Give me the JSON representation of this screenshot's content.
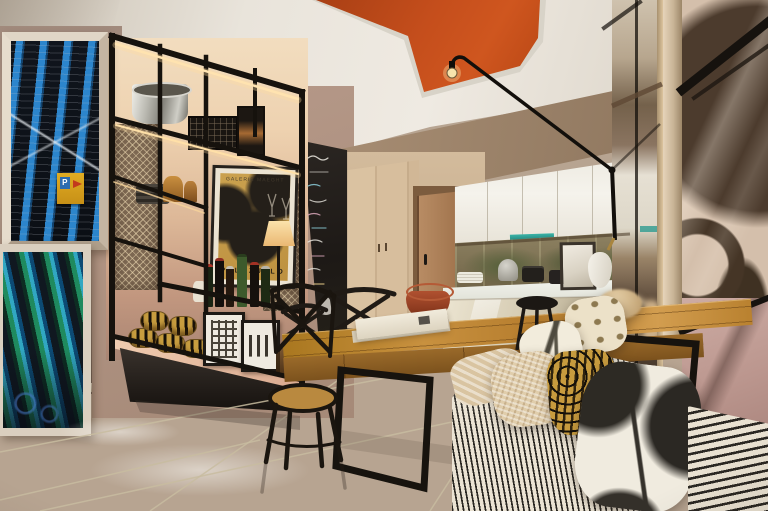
{
  "scene": {
    "type": "interior-photograph",
    "setting": "Modern open-plan apartment dining room with industrial black metal shelving, wooden dining table, striped bench sofa, kitchen and mirrored wall",
    "texts": {
      "poster_gallery": "GALERIE MAEGHT",
      "poster_artist": "PALAZUELO",
      "parking_letter": "P"
    },
    "palette": {
      "ceiling": "#e8e3da",
      "accent_orange": "#c2501d",
      "wall_taupe": "#ac9284",
      "backlight_warm": "#eed3b3",
      "metal_black": "#17130e",
      "wood_table": "#bb8538",
      "wardrobe_wood": "#d5bc9b",
      "door_wood": "#a87c55",
      "floor_cream": "#ebe2cc",
      "sofa_stripe_dark": "#2a2722",
      "sofa_stripe_light": "#ece4d4",
      "leopard_gold": "#c79b3e",
      "poster_gold": "#c49947",
      "teal_accent": "#2fa39a",
      "mirror_bronze": "#8a7460",
      "artwork_pink": "#c2a39c"
    },
    "objects": [
      {
        "name": "recessed-orange-ceiling-panel",
        "label": "Orange recessed ceiling panel with hanging bulb"
      },
      {
        "name": "potence-swing-arm-lamp",
        "label": "Black swing-arm wall lamp"
      },
      {
        "name": "pompidou-artwork-upper",
        "label": "Framed photo of blue building pipes with parking sign"
      },
      {
        "name": "pompidou-artwork-lower",
        "label": "Framed photo of green and blue diagonal tubes"
      },
      {
        "name": "black-metal-shelving",
        "label": "Backlit black metal shelving unit with mesh panels"
      },
      {
        "name": "gallery-poster",
        "label": "Gold Palazuelo gallery poster"
      },
      {
        "name": "chalkboard",
        "label": "Chalkboard strip with handwritten menu"
      },
      {
        "name": "wardrobe",
        "label": "Light wood wardrobe"
      },
      {
        "name": "entry-door",
        "label": "Wooden entry door"
      },
      {
        "name": "kitchen",
        "label": "White kitchen cabinets with bronze backsplash"
      },
      {
        "name": "island-counter",
        "label": "White kitchen island counter"
      },
      {
        "name": "bar-stool",
        "label": "Black bar stool"
      },
      {
        "name": "dining-table",
        "label": "Plank wood dining table with black steel legs"
      },
      {
        "name": "terracotta-bowl",
        "label": "Terracotta bowl"
      },
      {
        "name": "magazines",
        "label": "Stack of magazines"
      },
      {
        "name": "bistro-chairs",
        "label": "Black cross-back bistro chairs"
      },
      {
        "name": "striped-bench-sofa",
        "label": "Black and white ticking stripe bench sofa"
      },
      {
        "name": "patterned-pillows",
        "label": "Assorted animal print and woven pillows"
      },
      {
        "name": "mirror-wall",
        "label": "Mirrored wall panel"
      },
      {
        "name": "abstract-artwork-right",
        "label": "Large abstract circle artwork behind glass"
      },
      {
        "name": "tile-floor",
        "label": "Glossy cream tile floor"
      }
    ]
  }
}
